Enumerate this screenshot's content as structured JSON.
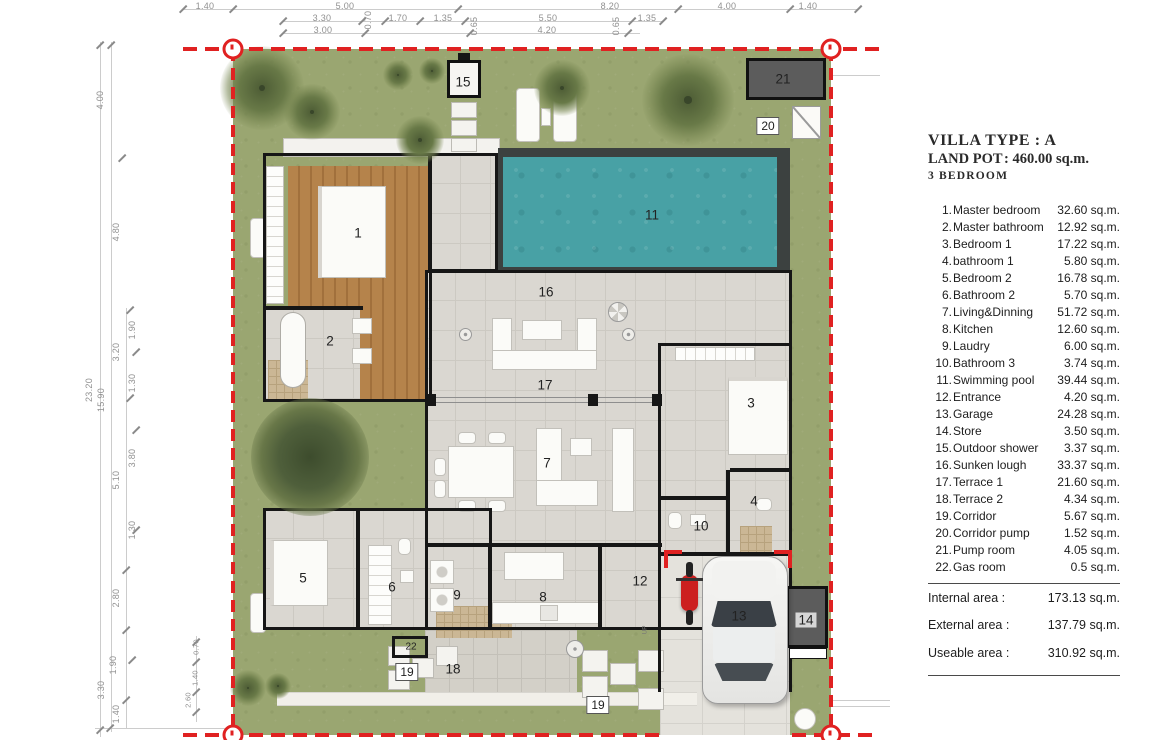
{
  "panel": {
    "title1": "VILLA TYPE : A",
    "title2_label": "LAND POT",
    "title2_value": ": 460.00 sq.m.",
    "title3": "3 BEDROOM",
    "rooms": [
      {
        "no": "1.",
        "name": "Master bedroom",
        "area": "32.60 sq.m."
      },
      {
        "no": "2.",
        "name": "Master bathroom",
        "area": "12.92 sq.m."
      },
      {
        "no": "3.",
        "name": "Bedroom 1",
        "area": "17.22 sq.m."
      },
      {
        "no": "4.",
        "name": "bathroom 1",
        "area": "5.80 sq.m."
      },
      {
        "no": "5.",
        "name": "Bedroom 2",
        "area": "16.78 sq.m."
      },
      {
        "no": "6.",
        "name": "Bathroom 2",
        "area": "5.70 sq.m."
      },
      {
        "no": "7.",
        "name": "Living&Dinning",
        "area": "51.72 sq.m."
      },
      {
        "no": "8.",
        "name": "Kitchen",
        "area": "12.60 sq.m."
      },
      {
        "no": "9.",
        "name": "Laudry",
        "area": "6.00 sq.m."
      },
      {
        "no": "10.",
        "name": "Bathroom 3",
        "area": "3.74 sq.m."
      },
      {
        "no": "11.",
        "name": "Swimming pool",
        "area": "39.44 sq.m."
      },
      {
        "no": "12.",
        "name": "Entrance",
        "area": "4.20 sq.m."
      },
      {
        "no": "13.",
        "name": "Garage",
        "area": "24.28 sq.m."
      },
      {
        "no": "14.",
        "name": "Store",
        "area": "3.50 sq.m."
      },
      {
        "no": "15.",
        "name": "Outdoor shower",
        "area": "3.37 sq.m."
      },
      {
        "no": "16.",
        "name": "Sunken lough",
        "area": "33.37 sq.m."
      },
      {
        "no": "17.",
        "name": "Terrace  1",
        "area": "21.60 sq.m."
      },
      {
        "no": "18.",
        "name": "Terrace  2",
        "area": "4.34 sq.m."
      },
      {
        "no": "19.",
        "name": "Corridor",
        "area": "5.67 sq.m."
      },
      {
        "no": "20.",
        "name": "Corridor pump",
        "area": "1.52 sq.m."
      },
      {
        "no": "21.",
        "name": "Pump  room",
        "area": "4.05 sq.m."
      },
      {
        "no": "22.",
        "name": "Gas  room",
        "area": "0.5 sq.m."
      }
    ],
    "totals": [
      {
        "label": "Internal area :",
        "value": "173.13 sq.m."
      },
      {
        "label": "External area :",
        "value": "137.79 sq.m."
      },
      {
        "label": "Useable area :",
        "value": "310.92 sq.m."
      }
    ]
  },
  "plan": {
    "labels": [
      {
        "text": "1",
        "x": 358,
        "y": 233
      },
      {
        "text": "2",
        "x": 330,
        "y": 341
      },
      {
        "text": "3",
        "x": 751,
        "y": 403
      },
      {
        "text": "4",
        "x": 754,
        "y": 501
      },
      {
        "text": "5",
        "x": 303,
        "y": 578
      },
      {
        "text": "6",
        "x": 392,
        "y": 587
      },
      {
        "text": "7",
        "x": 547,
        "y": 463
      },
      {
        "text": "8",
        "x": 543,
        "y": 597
      },
      {
        "text": "9",
        "x": 457,
        "y": 595
      },
      {
        "text": "10",
        "x": 701,
        "y": 526
      },
      {
        "text": "11",
        "x": 652,
        "y": 215
      },
      {
        "text": "12",
        "x": 640,
        "y": 581
      },
      {
        "text": "13",
        "x": 739,
        "y": 616
      },
      {
        "text": "14",
        "x": 806,
        "y": 620,
        "cls": "on-dark"
      },
      {
        "text": "15",
        "x": 463,
        "y": 82
      },
      {
        "text": "16",
        "x": 546,
        "y": 292
      },
      {
        "text": "17",
        "x": 545,
        "y": 385
      },
      {
        "text": "18",
        "x": 453,
        "y": 669
      },
      {
        "text": "19",
        "x": 407,
        "y": 672,
        "cls": "boxed"
      },
      {
        "text": "19",
        "x": 598,
        "y": 705,
        "cls": "boxed"
      },
      {
        "text": "20",
        "x": 768,
        "y": 126,
        "cls": "boxed"
      },
      {
        "text": "21",
        "x": 783,
        "y": 79
      },
      {
        "text": "22",
        "x": 411,
        "y": 647,
        "cls": "small"
      },
      {
        "text": "UP",
        "x": 645,
        "y": 630,
        "cls": "up"
      }
    ]
  },
  "dimensions": {
    "top": [
      {
        "t": "1.40",
        "x": 205,
        "y": 6
      },
      {
        "t": "5.00",
        "x": 345,
        "y": 6
      },
      {
        "t": "8.20",
        "x": 610,
        "y": 6
      },
      {
        "t": "4.00",
        "x": 727,
        "y": 6
      },
      {
        "t": "1.40",
        "x": 808,
        "y": 6
      },
      {
        "t": "3.30",
        "x": 322,
        "y": 18
      },
      {
        "t": "1.70",
        "x": 398,
        "y": 18
      },
      {
        "t": "1.35",
        "x": 443,
        "y": 18
      },
      {
        "t": "5.50",
        "x": 548,
        "y": 18
      },
      {
        "t": "1.35",
        "x": 647,
        "y": 18
      },
      {
        "t": "3.00",
        "x": 323,
        "y": 30
      },
      {
        "t": "4.20",
        "x": 547,
        "y": 30
      },
      {
        "t": "0.70",
        "x": 368,
        "y": 20,
        "rot": true
      },
      {
        "t": "0.65",
        "x": 474,
        "y": 26,
        "rot": true
      },
      {
        "t": "0.65",
        "x": 616,
        "y": 26,
        "rot": true
      }
    ],
    "left": [
      {
        "t": "4.00",
        "x": 100,
        "y": 100,
        "rot": true
      },
      {
        "t": "4.80",
        "x": 116,
        "y": 232,
        "rot": true
      },
      {
        "t": "1.90",
        "x": 132,
        "y": 330,
        "rot": true
      },
      {
        "t": "3.20",
        "x": 116,
        "y": 352,
        "rot": true
      },
      {
        "t": "1.30",
        "x": 132,
        "y": 383,
        "rot": true
      },
      {
        "t": "23.20",
        "x": 89,
        "y": 390,
        "rot": true
      },
      {
        "t": "15.90",
        "x": 101,
        "y": 400,
        "rot": true
      },
      {
        "t": "3.80",
        "x": 132,
        "y": 458,
        "rot": true
      },
      {
        "t": "5.10",
        "x": 116,
        "y": 480,
        "rot": true
      },
      {
        "t": "1.30",
        "x": 132,
        "y": 530,
        "rot": true
      },
      {
        "t": "2.80",
        "x": 116,
        "y": 598,
        "rot": true
      },
      {
        "t": "1.90",
        "x": 113,
        "y": 665,
        "rot": true
      },
      {
        "t": "3.30",
        "x": 101,
        "y": 690,
        "rot": true
      },
      {
        "t": "1.40",
        "x": 116,
        "y": 714,
        "rot": true
      },
      {
        "t": "0.70",
        "x": 196,
        "y": 647,
        "rot": true,
        "sm": true
      },
      {
        "t": "1.40",
        "x": 195,
        "y": 678,
        "rot": true,
        "sm": true
      },
      {
        "t": "2.60",
        "x": 188,
        "y": 700,
        "rot": true,
        "sm": true
      }
    ],
    "ticks": [
      [
        183,
        9
      ],
      [
        233,
        9
      ],
      [
        458,
        9
      ],
      [
        678,
        9
      ],
      [
        790,
        9
      ],
      [
        858,
        9
      ],
      [
        283,
        21
      ],
      [
        362,
        21
      ],
      [
        385,
        21
      ],
      [
        420,
        21
      ],
      [
        465,
        21
      ],
      [
        632,
        21
      ],
      [
        663,
        21
      ],
      [
        283,
        33
      ],
      [
        365,
        33
      ],
      [
        470,
        33
      ],
      [
        628,
        33
      ],
      [
        100,
        45
      ],
      [
        111,
        45
      ],
      [
        122,
        158
      ],
      [
        130,
        310
      ],
      [
        136,
        352
      ],
      [
        130,
        398
      ],
      [
        136,
        430
      ],
      [
        136,
        530
      ],
      [
        126,
        570
      ],
      [
        126,
        630
      ],
      [
        132,
        660
      ],
      [
        126,
        700
      ],
      [
        110,
        728
      ],
      [
        100,
        730
      ],
      [
        196,
        642
      ],
      [
        196,
        662
      ],
      [
        196,
        692
      ],
      [
        196,
        712
      ]
    ]
  },
  "colors": {
    "grass": "#9aa671",
    "pool_water": "#48a1a5",
    "pool_frame": "#3c4140",
    "wood_floor": "#b5834b",
    "tile_floor": "#dad7d1",
    "boundary_red": "#e02121",
    "wall_black": "#161616"
  }
}
